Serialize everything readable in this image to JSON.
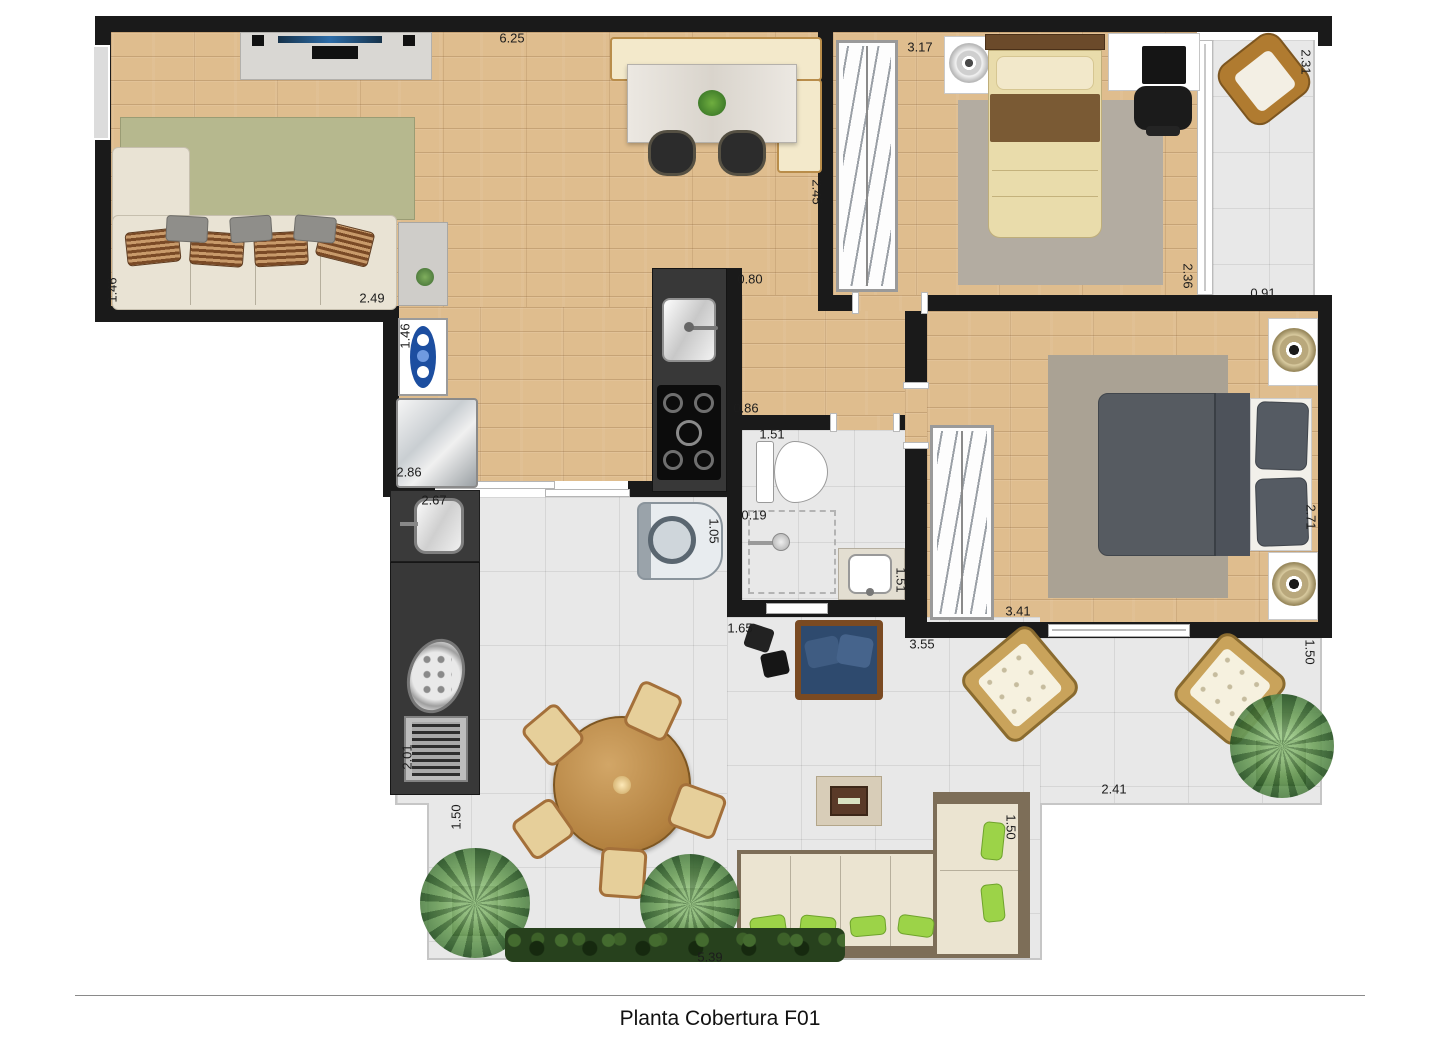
{
  "title": "Planta Cobertura F01",
  "colors": {
    "wall": "#1a1a1a",
    "wood": "#dfbd8e",
    "tile": "#e8e8e8",
    "rug-living": "#b6b88e",
    "rug-bedroom": "#b3aca1",
    "sofa-cream": "#e9e3d4",
    "bed-dark": "#565b61",
    "accent-green": "#9cd348",
    "chair-blue": "#2e4a6e",
    "wicker": "#b07b30",
    "counter-dark": "#383838"
  },
  "dimensions": [
    {
      "value": "6.25",
      "x": 512,
      "y": 38,
      "rot": 0
    },
    {
      "value": "3.17",
      "x": 920,
      "y": 47,
      "rot": 0
    },
    {
      "value": "2.31",
      "x": 1306,
      "y": 62,
      "rot": 90
    },
    {
      "value": "2.45",
      "x": 817,
      "y": 192,
      "rot": 90
    },
    {
      "value": "1.46",
      "x": 112,
      "y": 290,
      "rot": -90
    },
    {
      "value": "2.49",
      "x": 372,
      "y": 298,
      "rot": 0
    },
    {
      "value": "1.46",
      "x": 405,
      "y": 336,
      "rot": -90
    },
    {
      "value": "0.80",
      "x": 750,
      "y": 279,
      "rot": 0
    },
    {
      "value": "2.36",
      "x": 1188,
      "y": 276,
      "rot": 90
    },
    {
      "value": "0.91",
      "x": 1263,
      "y": 293,
      "rot": 0
    },
    {
      "value": "2.86",
      "x": 409,
      "y": 472,
      "rot": 0
    },
    {
      "value": "0.86",
      "x": 746,
      "y": 408,
      "rot": 0
    },
    {
      "value": "1.51",
      "x": 772,
      "y": 434,
      "rot": 0
    },
    {
      "value": "2.67",
      "x": 434,
      "y": 500,
      "rot": 0
    },
    {
      "value": "0.19",
      "x": 754,
      "y": 515,
      "rot": 0
    },
    {
      "value": "1.05",
      "x": 714,
      "y": 531,
      "rot": 90
    },
    {
      "value": "1.51",
      "x": 901,
      "y": 580,
      "rot": 90
    },
    {
      "value": "2.71",
      "x": 1311,
      "y": 517,
      "rot": 90
    },
    {
      "value": "3.41",
      "x": 1018,
      "y": 611,
      "rot": 0
    },
    {
      "value": "1.65",
      "x": 740,
      "y": 628,
      "rot": 0
    },
    {
      "value": "3.55",
      "x": 922,
      "y": 644,
      "rot": 0
    },
    {
      "value": "2.01",
      "x": 407,
      "y": 757,
      "rot": -90
    },
    {
      "value": "1.50",
      "x": 456,
      "y": 817,
      "rot": -90
    },
    {
      "value": "2.41",
      "x": 1114,
      "y": 789,
      "rot": 0
    },
    {
      "value": "1.50",
      "x": 1011,
      "y": 827,
      "rot": 90
    },
    {
      "value": "1.50",
      "x": 1310,
      "y": 652,
      "rot": 90
    },
    {
      "value": "5.39",
      "x": 710,
      "y": 957,
      "rot": 0
    }
  ]
}
